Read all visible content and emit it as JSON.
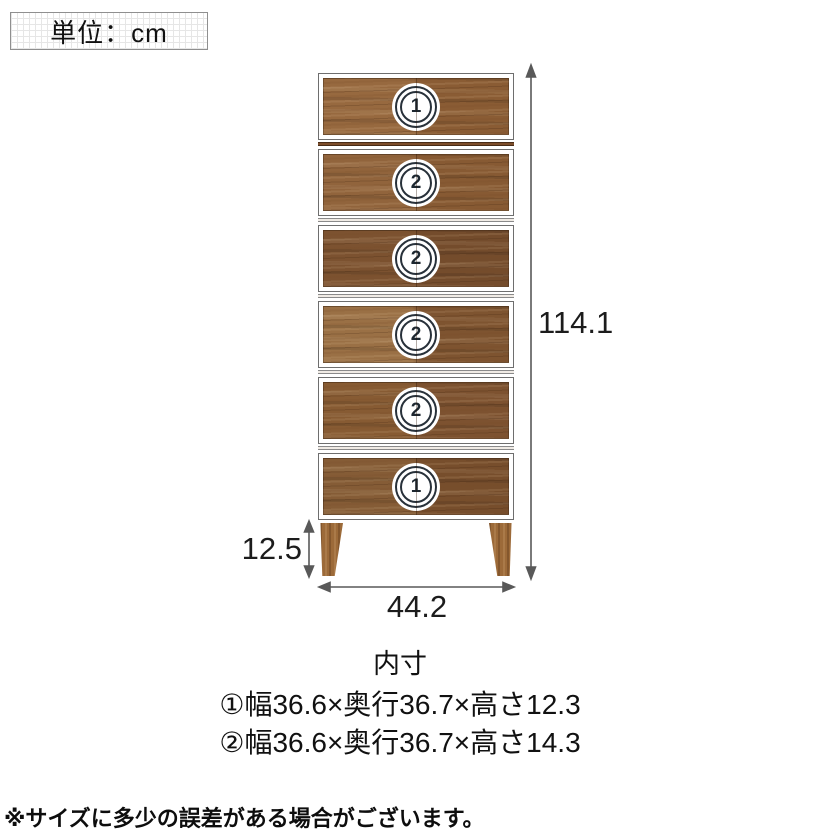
{
  "unit_box": {
    "label": "単位：cm"
  },
  "chest": {
    "drawers": [
      {
        "badge": "1"
      },
      {
        "badge": "2"
      },
      {
        "badge": "2"
      },
      {
        "badge": "2"
      },
      {
        "badge": "2"
      },
      {
        "badge": "1"
      }
    ]
  },
  "dimensions": {
    "total_height": "114.1",
    "leg_height": "12.5",
    "width": "44.2"
  },
  "inner_dimensions": {
    "title": "内寸",
    "items": [
      {
        "label": "①幅36.6×奥行36.7×高さ12.3"
      },
      {
        "label": "②幅36.6×奥行36.7×高さ14.3"
      }
    ]
  },
  "footnote": "※サイズに多少の誤差がある場合がございます。",
  "colors": {
    "wood_base": "#8a5c36",
    "wood_dark": "#744c2c",
    "leg_wood": "#9c6a39",
    "rail_brown": "#7d4e2b",
    "dimension_line": "#595959",
    "text": "#1a1a1a",
    "grid_line": "#e6e6e6"
  }
}
